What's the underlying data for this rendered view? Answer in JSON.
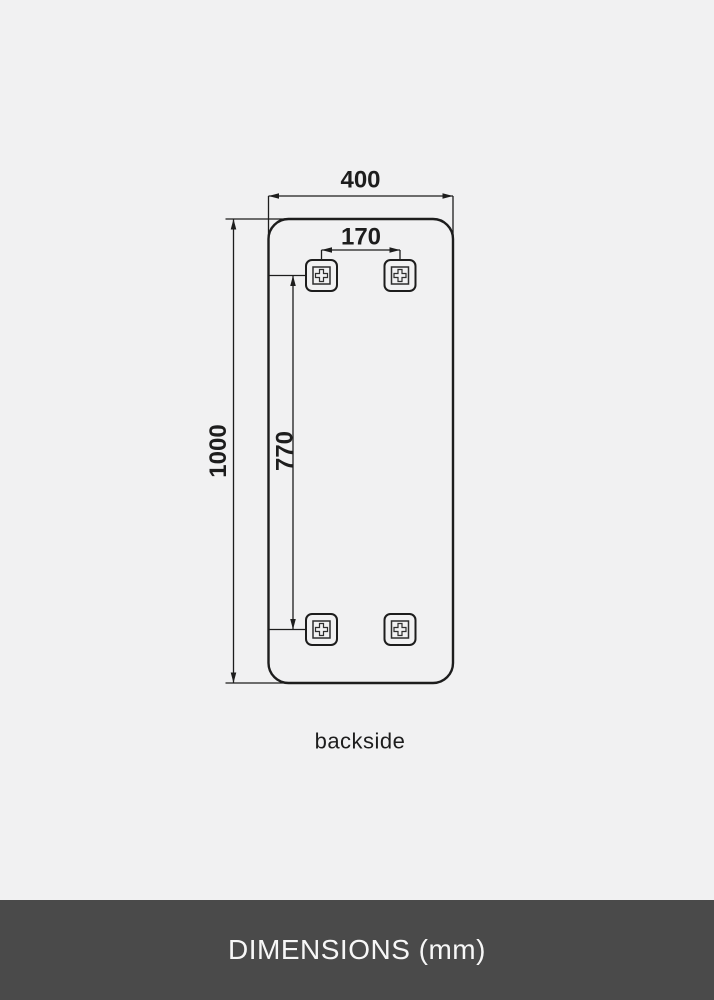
{
  "colors": {
    "canvas_background": "#f1f1f2",
    "line": "#1d1d1d",
    "footer_background": "#4a4a4a",
    "footer_text": "#f7f7f7"
  },
  "diagram": {
    "unit": "mm",
    "labels": {
      "overall_width": "400",
      "hole_spacing_horizontal": "170",
      "overall_height": "1000",
      "hole_spacing_vertical": "770"
    },
    "caption": "backside",
    "mounting_points": 4
  },
  "footer": {
    "title": "DIMENSIONS (mm)"
  }
}
